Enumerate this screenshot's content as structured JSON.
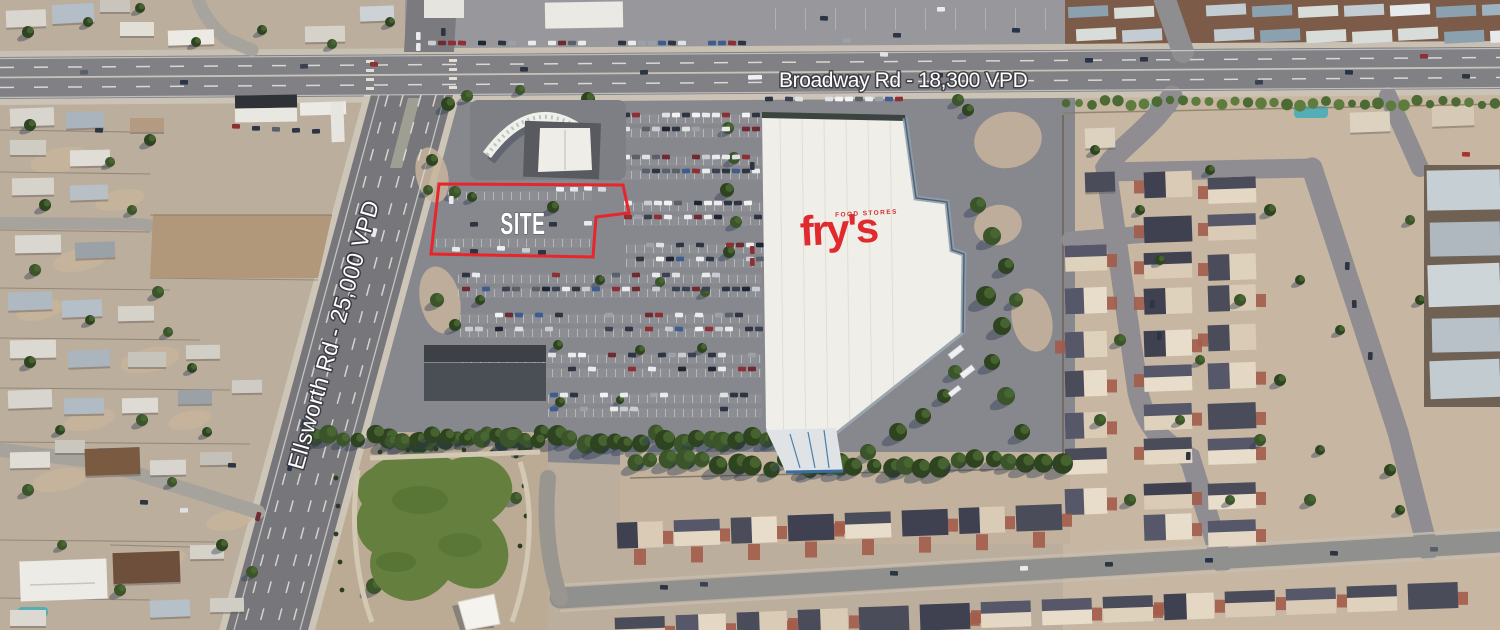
{
  "annotations": {
    "broadway_label": "Broadway Rd - 18,300 VPD",
    "ellsworth_label": "Ellsworth Rd - 25,000 VPD",
    "site_label": "SITE",
    "outline_color": "#e8252b",
    "label_color": "#ffffff"
  },
  "landmarks": {
    "frys_logo": "fry's",
    "frys_sub": "FOOD STORES",
    "frys_color": "#e02a2e"
  }
}
